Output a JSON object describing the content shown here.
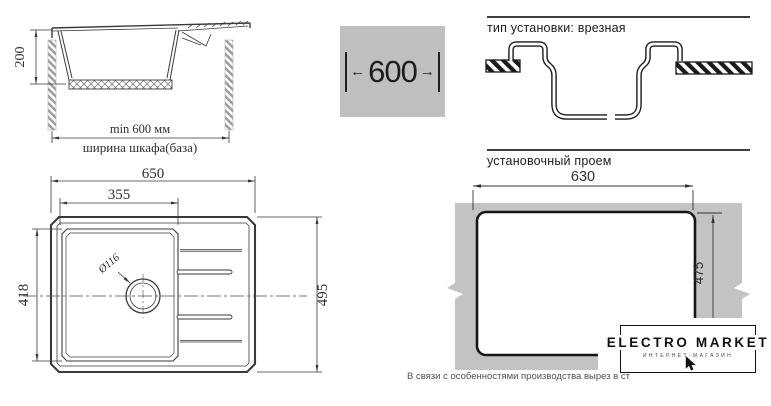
{
  "colors": {
    "line": "#3a3a3a",
    "dark_line": "#1a1a1a",
    "countertop_gray": "#c3c3c3",
    "box_gray": "#bfbfbf"
  },
  "headings": {
    "install_type": "тип установки: врезная",
    "cutout": "установочный проем"
  },
  "width_box": {
    "value": "600",
    "left_arrow": "←",
    "right_arrow": "→"
  },
  "side_view": {
    "depth": "200",
    "min_width": "min 600 мм",
    "cabinet_label": "ширина шкафа(база)"
  },
  "top_view": {
    "width": "650",
    "bowl_width": "355",
    "bowl_depth": "418",
    "length": "495",
    "drain_diameter": "Ø116"
  },
  "cutout": {
    "width": "630",
    "height": "475"
  },
  "logo": {
    "title": "ELECTRO MARKET",
    "subtitle": "ИНТЕРНЕТ-МАГАЗИН"
  },
  "footnote": "В связи с особенностями производства вырез в ст"
}
